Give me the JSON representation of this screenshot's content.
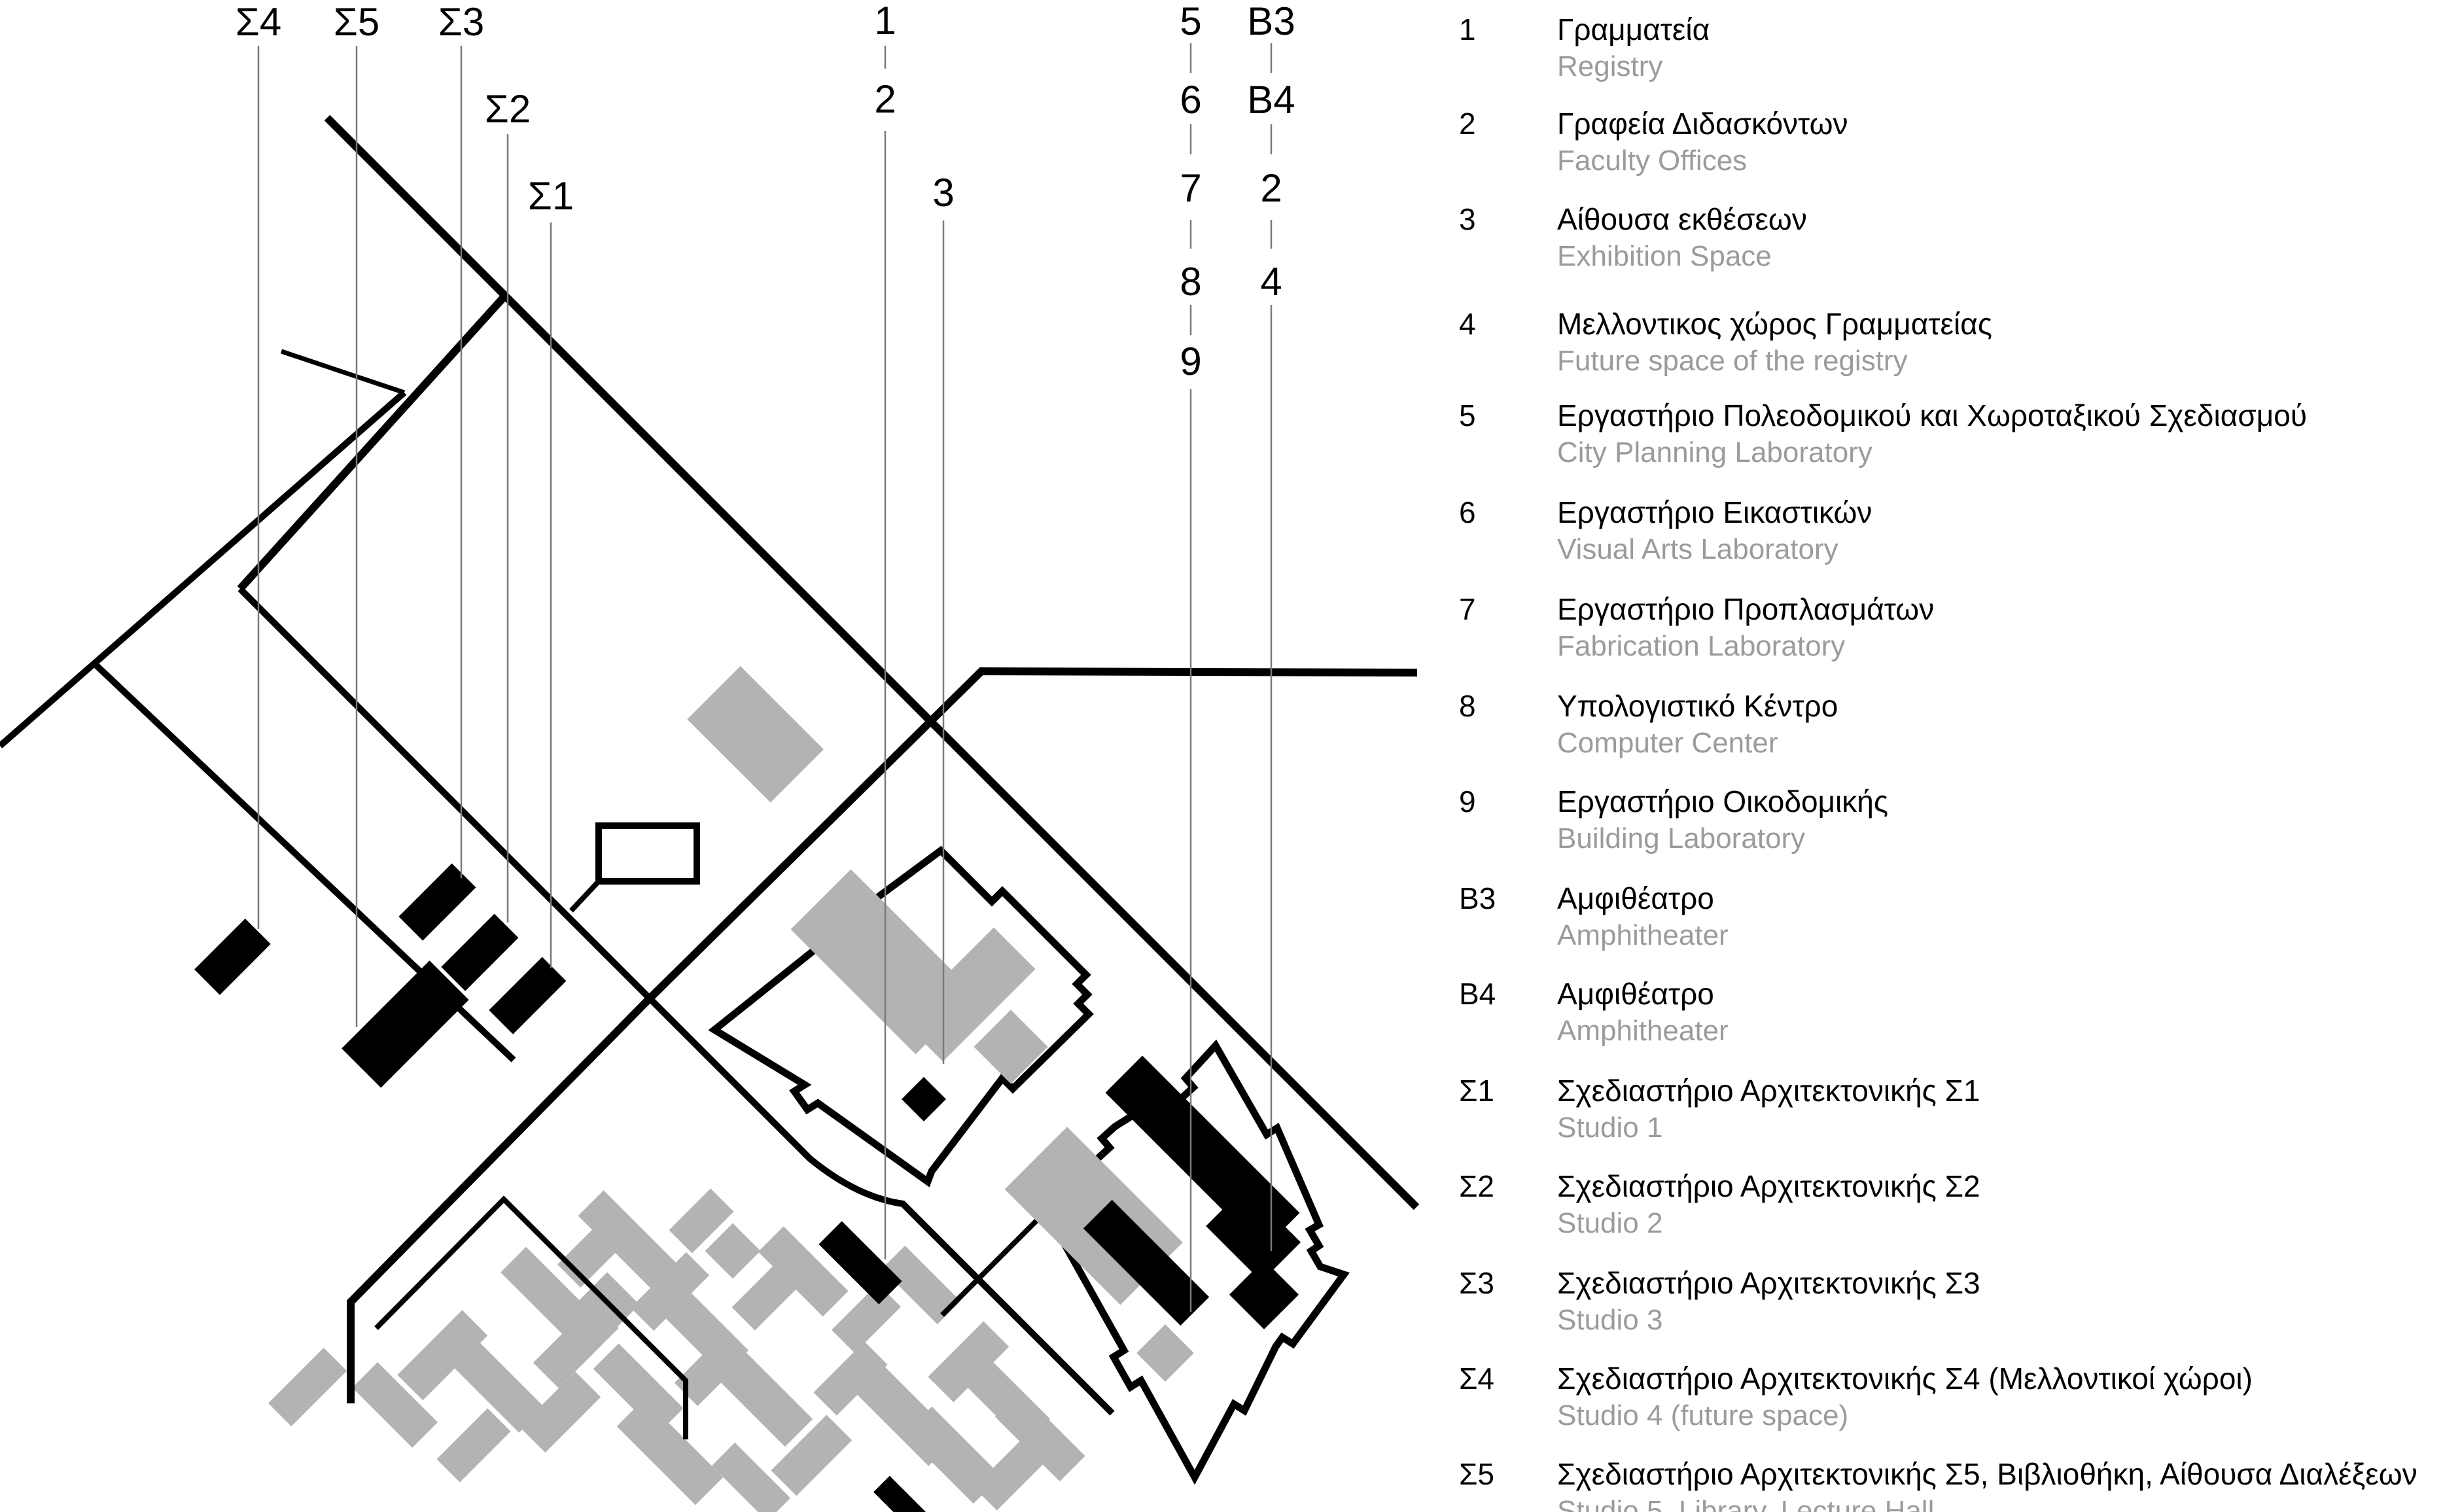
{
  "title": "Campus site plan with building legend",
  "colors": {
    "black": "#000000",
    "building_gray": "#b3b3b3",
    "label_gray": "#9b9b9b",
    "leader_gray": "#7a7a7a"
  },
  "map": {
    "labels": [
      {
        "id": "sigma4",
        "text": "Σ4"
      },
      {
        "id": "sigma5",
        "text": "Σ5"
      },
      {
        "id": "sigma3",
        "text": "Σ3"
      },
      {
        "id": "sigma2",
        "text": "Σ2"
      },
      {
        "id": "sigma1",
        "text": "Σ1"
      },
      {
        "id": "n1",
        "text": "1"
      },
      {
        "id": "n2",
        "text": "2"
      },
      {
        "id": "n3",
        "text": "3"
      },
      {
        "id": "n5",
        "text": "5"
      },
      {
        "id": "n6",
        "text": "6"
      },
      {
        "id": "n7",
        "text": "7"
      },
      {
        "id": "n8",
        "text": "8"
      },
      {
        "id": "n9",
        "text": "9"
      },
      {
        "id": "b3",
        "text": "B3"
      },
      {
        "id": "b4",
        "text": "B4"
      },
      {
        "id": "n2b",
        "text": "2"
      },
      {
        "id": "n4",
        "text": "4"
      }
    ]
  },
  "legend": {
    "items": [
      {
        "id": "1",
        "greek": "Γραμματεία",
        "english": "Registry"
      },
      {
        "id": "2",
        "greek": "Γραφεία Διδασκόντων",
        "english": "Faculty Offices"
      },
      {
        "id": "3",
        "greek": "Αίθουσα εκθέσεων",
        "english": "Exhibition Space"
      },
      {
        "id": "4",
        "greek": "Μελλοντικος χώρος Γραμματείας",
        "english": "Future space of the registry"
      },
      {
        "id": "5",
        "greek": "Εργαστήριο Πολεοδομικού και Χωροταξικού Σχεδιασμού",
        "english": "City Planning Laboratory"
      },
      {
        "id": "6",
        "greek": "Εργαστήριο Εικαστικών",
        "english": "Visual Arts Laboratory"
      },
      {
        "id": "7",
        "greek": "Εργαστήριο Προπλασμάτων",
        "english": "Fabrication Laboratory"
      },
      {
        "id": "8",
        "greek": "Υπολογιστικό Κέντρο",
        "english": "Computer Center"
      },
      {
        "id": "9",
        "greek": "Εργαστήριο Οικοδομικής",
        "english": "Building Laboratory"
      },
      {
        "id": "B3",
        "greek": "Αμφιθέατρο",
        "english": "Amphitheater"
      },
      {
        "id": "B4",
        "greek": "Αμφιθέατρο",
        "english": "Amphitheater"
      },
      {
        "id": "Σ1",
        "greek": "Σχεδιαστήριο Αρχιτεκτονικής Σ1",
        "english": "Studio 1"
      },
      {
        "id": "Σ2",
        "greek": "Σχεδιαστήριο Αρχιτεκτονικής Σ2",
        "english": "Studio 2"
      },
      {
        "id": "Σ3",
        "greek": "Σχεδιαστήριο Αρχιτεκτονικής Σ3",
        "english": "Studio 3"
      },
      {
        "id": "Σ4",
        "greek": "Σχεδιαστήριο Αρχιτεκτονικής Σ4 (Μελλοντικοί χώροι)",
        "english": "Studio 4 (future space)"
      },
      {
        "id": "Σ5",
        "greek": "Σχεδιαστήριο Αρχιτεκτονικής Σ5, Βιβλιοθήκη, Αίθουσα Διαλέξεων",
        "english": "Studio 5, Library, Lecture Hall"
      }
    ]
  }
}
